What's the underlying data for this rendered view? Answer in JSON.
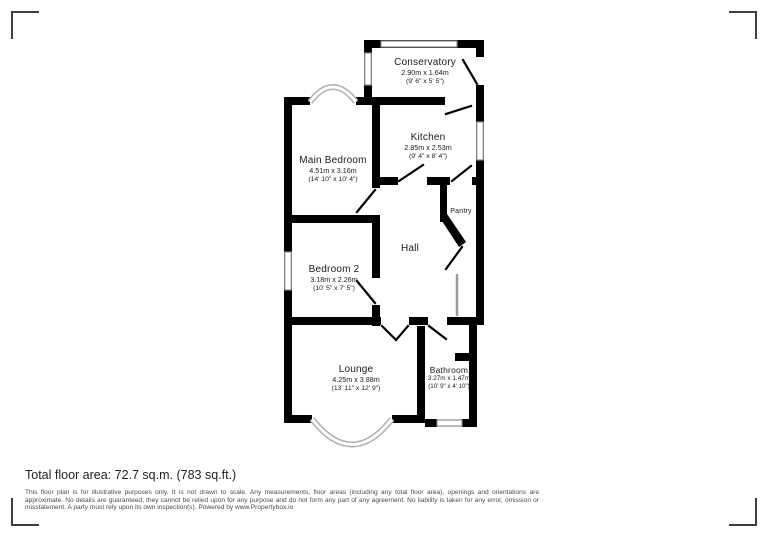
{
  "plan": {
    "rooms": [
      {
        "name": "Conservatory",
        "metric": "2.90m x 1.64m",
        "imperial": "(9' 6\" x 5' 5\")"
      },
      {
        "name": "Kitchen",
        "metric": "2.85m x 2.53m",
        "imperial": "(9' 4\" x 8' 4\")"
      },
      {
        "name": "Main Bedroom",
        "metric": "4.51m x 3.16m",
        "imperial": "(14' 10\" x 10' 4\")"
      },
      {
        "name": "Pantry"
      },
      {
        "name": "Hall"
      },
      {
        "name": "Bedroom 2",
        "metric": "3.18m x 2.26m",
        "imperial": "(10' 5\" x 7' 5\")"
      },
      {
        "name": "Lounge",
        "metric": "4.25m x 3.88m",
        "imperial": "(13' 11\" x 12' 9\")"
      },
      {
        "name": "Bathroom",
        "metric": "3.27m x 1.47m",
        "imperial": "(10' 9\" x 4' 10\")"
      }
    ]
  },
  "footer": {
    "total_area": "Total floor area: 72.7 sq.m. (783 sq.ft.)",
    "disclaimer": "This floor plan is for illustrative purposes only. It is not drawn to scale. Any measurements, floor areas (including any total floor area), openings and orientations are approximate. No details are guaranteed, they cannot be relied upon for any purpose and do not form any part of any agreement. No liability is taken for any error, omission or misstatement. A party must rely upon its own inspection(s). Powered by www.Propertybox.io"
  },
  "colors": {
    "wall": "#000000",
    "window_border": "#8c8c8c",
    "bay_window": "#b0b0b0",
    "corner_mark": "#3f3f3f",
    "text": "#1a1a1a"
  }
}
